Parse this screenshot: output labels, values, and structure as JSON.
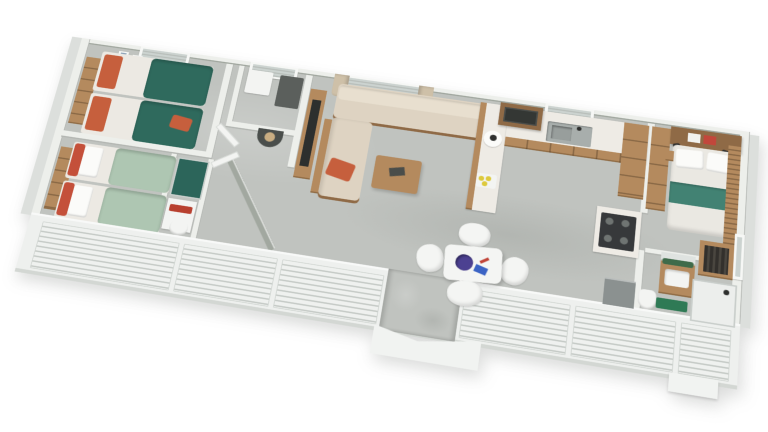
{
  "scene": {
    "label": "3D aerial cutaway floor plan of a rectangular mobile home, viewed at an angle on a white background",
    "view": "axonometric top-down, rotated, long axis running lower-left to upper-right",
    "background": "#ffffff"
  },
  "palette": {
    "floor": "#c0c3bf",
    "wallTop": "#edefeb",
    "wallFace": "#a2a8a0",
    "exterior": "#dcdfdc",
    "bandBg": "#eef0ee",
    "slatLine": "#c6cbc7",
    "glass": "#ccd3d0",
    "blindLine": "#b9bfbb",
    "wood": "#b48a5e",
    "woodDark": "#8f6a46",
    "teal": "#2f6a5d",
    "tealRunner": "#428273",
    "sage": "#aec6b2",
    "orange": "#c65f3d",
    "redCushion": "#c4503a",
    "towelRed": "#b8402f",
    "sofa": "#ded3c2",
    "sofaBack": "#e8dfcf",
    "marble": "#eeebe5",
    "steel": "#a8aeac",
    "appliance": "#37393b",
    "charcoal": "#5b5f5c",
    "matGreen": "#2f7a55",
    "showerTeal": "#2c655a",
    "duvet": "#eae8e2",
    "curtain": "#cec0a8",
    "tan": "#c9ad82",
    "tableWhite": "#f4f5f3",
    "decorPurple": "#4c4191",
    "decorBlue": "#3b63c4",
    "lemon": "#ddc93c",
    "greyBox": "#8b9190"
  },
  "rooms": [
    {
      "id": "bedroom-twin-rear-left",
      "label": "Twin bedroom (rear left)",
      "furniture": [
        "twin bed with teal cover and orange pillow",
        "twin bed with teal cover and orange accent cushion",
        "wooden wall shelf unit",
        "two small picture frames",
        "window with blinds"
      ]
    },
    {
      "id": "bedroom-twin-front-left",
      "label": "Twin bedroom (front left)",
      "furniture": [
        "twin bed with sage cover, white pillow, red head cushion",
        "second identical twin bed",
        "wooden wall shelf unit"
      ]
    },
    {
      "id": "shower-room",
      "label": "Family shower room",
      "furniture": [
        "dark teal shower tray",
        "white vanity with red towel",
        "toilet"
      ]
    },
    {
      "id": "wc-rear",
      "label": "Rear WC",
      "furniture": [
        "white washbasin unit",
        "dark counter",
        "window with blinds"
      ]
    },
    {
      "id": "hallway",
      "label": "Hallway with angled wall",
      "furniture": [
        "dark half-round console table",
        "tan vase",
        "open white doors"
      ]
    },
    {
      "id": "living-room",
      "label": "Living room",
      "furniture": [
        "beige L-shaped corner sofa with orange cushion",
        "wooden coffee table",
        "TV on wooden media unit",
        "window with tan curtains"
      ]
    },
    {
      "id": "kitchen",
      "label": "U-shaped kitchen",
      "furniture": [
        "white worktop peninsula with lemons and round tray",
        "rear counter with stainless sink",
        "wood upper cabinet with microwave",
        "tall wooden fridge cabinet",
        "gas hob unit with 4 burners",
        "window with blinds"
      ]
    },
    {
      "id": "dining-area",
      "label": "Dining area",
      "furniture": [
        "white square table",
        "purple fruit bowl",
        "blue magazines",
        "four white shell chairs"
      ]
    },
    {
      "id": "bedroom-master",
      "label": "Master bedroom (right end)",
      "furniture": [
        "double bed with white duvet and teal runner",
        "two white pillows",
        "wooden headboard shelf with white and red books",
        "tall wooden wardrobe",
        "bedside tables",
        "black wall lamps",
        "wood slat accent wall",
        "side window"
      ]
    },
    {
      "id": "ensuite",
      "label": "En-suite bathroom",
      "furniture": [
        "wooden vanity with white basin and plant",
        "mirror",
        "green bath mat",
        "white shower cubicle",
        "toilet",
        "open wardrobe with dark hanging clothes",
        "grey utility box"
      ]
    }
  ],
  "exterior": {
    "front_wall": "white wall with six slatted shutter panels",
    "entrance": "central open doorway with white V-shaped access steps",
    "secondary_step": "small white step at right end",
    "rear_windows": 4,
    "side_window_right": 1
  }
}
